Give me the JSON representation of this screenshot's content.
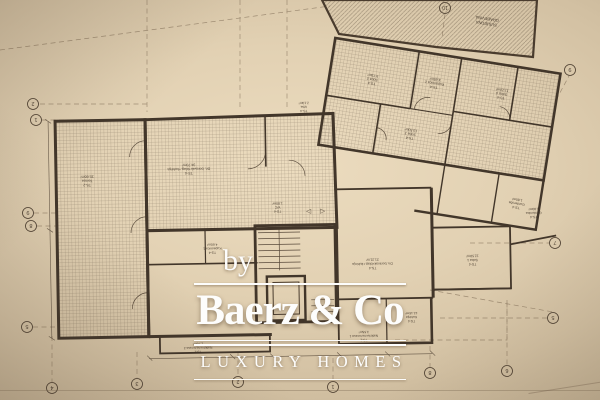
{
  "watermark": {
    "by": "by",
    "brand": "Baerz & Co",
    "tagline": "LUXURY HOMES"
  },
  "plan": {
    "neighbor": {
      "line1": "SUSJEDNA",
      "line2": "GRAĐEVINA"
    },
    "symbols": {
      "arrow_left": "◁",
      "arrow_right": "▷"
    },
    "rooms": [
      {
        "code": "TS-2",
        "name": "Terasa",
        "area": "35.60m²"
      },
      {
        "code": "TS-4",
        "name": "Dn. boravak+blag.+kuhinja",
        "area": "34.70m²"
      },
      {
        "code": "TS-4",
        "name": "WC",
        "area": "1.80m²"
      },
      {
        "code": "TS-4",
        "name": "Kupaonica 1",
        "area": "4.60m²"
      },
      {
        "code": "TS-4",
        "name": "Dn. boravak+blag.+kuhinja",
        "area": "21.21m²"
      },
      {
        "code": "TS-4",
        "name": "Soba 1",
        "area": "12.59m²"
      },
      {
        "code": "TS-4",
        "name": "Kuhinja",
        "area": "12.16m²"
      },
      {
        "code": "TS-2",
        "name": "Natkrivena terasa 1",
        "area": "3.55m²"
      },
      {
        "code": "TS-2",
        "name": "Natkrivena terasa 2",
        "area": "1.76m²"
      },
      {
        "code": "TS-4",
        "name": "Soba 2",
        "area": "9.73m²"
      },
      {
        "code": "TS-4",
        "name": "Kupaonica 2",
        "area": "4.65m²"
      },
      {
        "code": "TS-4",
        "name": "Soba 3",
        "area": "10.50m²"
      },
      {
        "code": "TS-4",
        "name": "Soba 4",
        "area": "11.20m²"
      },
      {
        "code": "TS-4",
        "name": "Garderoba",
        "area": "1.80m²"
      },
      {
        "code": "TS-4",
        "name": "Izba",
        "area": "2.10m²"
      }
    ],
    "grid_bubbles": [
      {
        "label": "2"
      },
      {
        "label": "1"
      },
      {
        "label": "9"
      },
      {
        "label": "8"
      },
      {
        "label": "5"
      },
      {
        "label": "4"
      },
      {
        "label": "3"
      },
      {
        "label": "2"
      },
      {
        "label": "1"
      },
      {
        "label": "8"
      },
      {
        "label": "6"
      },
      {
        "label": "5"
      },
      {
        "label": "7"
      },
      {
        "label": "9"
      },
      {
        "label": "10"
      }
    ],
    "colors": {
      "paper": "#d9c8ab",
      "paper_dark": "#a8977e",
      "ink": "#42362a",
      "watermark": "#fdfdfc"
    }
  }
}
